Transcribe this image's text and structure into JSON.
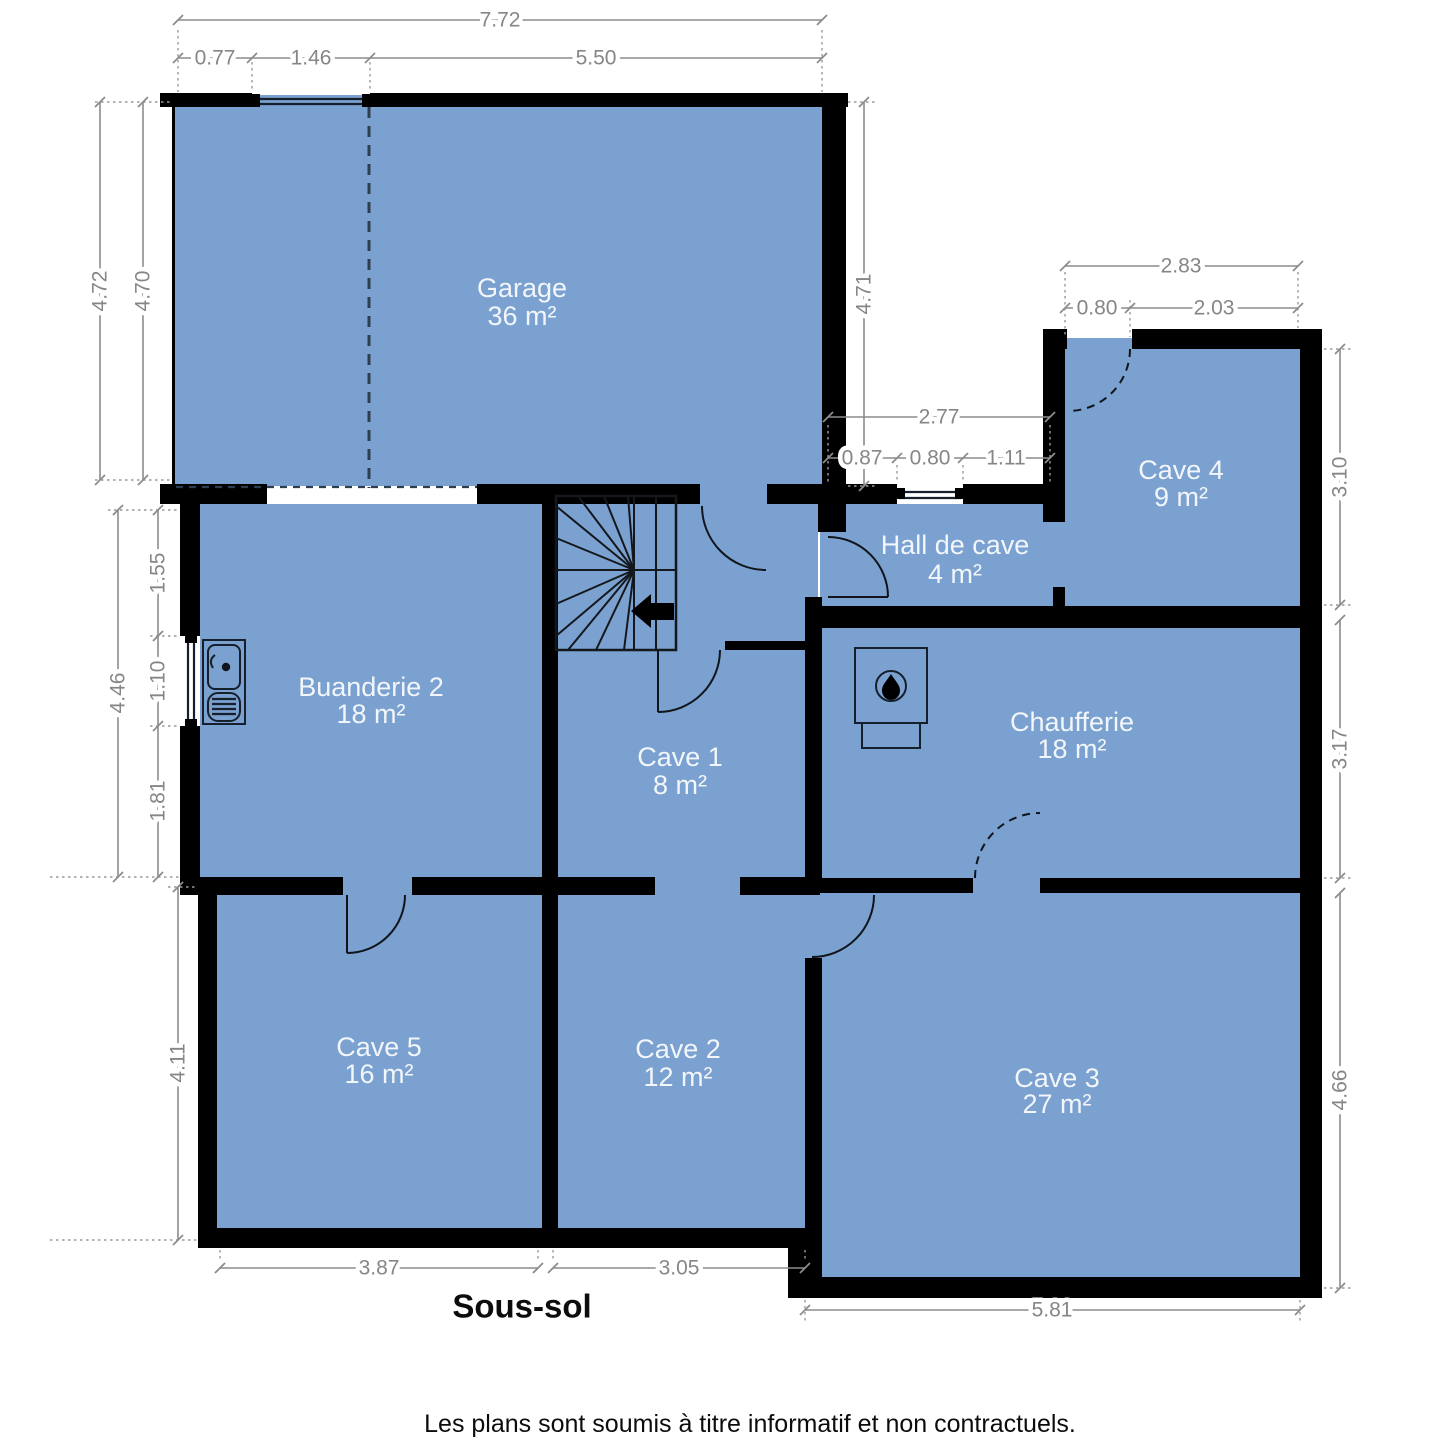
{
  "plan": {
    "title": "Sous-sol",
    "disclaimer": "Les plans sont soumis à titre informatif et non contractuels.",
    "colors": {
      "room_fill": "#7aa1cf",
      "wall": "#000000",
      "dimension_text": "#868686",
      "room_label_text": "#f2f6fb"
    },
    "icons": {
      "stairs": "winder-staircase",
      "arrow": "stair-direction-arrow",
      "sink": "laundry-sink",
      "boiler": "boiler-flame"
    },
    "rooms": [
      {
        "name": "Garage",
        "area": "36 m²"
      },
      {
        "name": "Cave 4",
        "area": "9 m²"
      },
      {
        "name": "Hall de cave",
        "area": "4 m²"
      },
      {
        "name": "Buanderie 2",
        "area": "18 m²"
      },
      {
        "name": "Cave 1",
        "area": "8 m²"
      },
      {
        "name": "Chaufferie",
        "area": "18 m²"
      },
      {
        "name": "Cave 5",
        "area": "16 m²"
      },
      {
        "name": "Cave 2",
        "area": "12 m²"
      },
      {
        "name": "Cave 3",
        "area": "27 m²"
      }
    ],
    "dimensions": {
      "top_total": "7.72",
      "top_a": "0.77",
      "top_b": "1.46",
      "top_c": "5.50",
      "left_outer": "4.72",
      "left_inner": "4.70",
      "right_garage": "4.71",
      "cave4_total": "2.83",
      "cave4_a": "0.80",
      "cave4_b": "2.03",
      "hall_total": "2.77",
      "hall_a": "0.87",
      "hall_b": "0.80",
      "hall_c": "1.11",
      "right_a": "3.10",
      "right_b": "3.17",
      "right_c": "4.66",
      "left_mid_total": "4.46",
      "left_mid_a": "1.55",
      "left_mid_b": "1.10",
      "left_mid_c": "1.81",
      "left_low": "4.11",
      "bottom_a": "3.87",
      "bottom_b": "3.05",
      "bottom_c": "5.81"
    }
  }
}
